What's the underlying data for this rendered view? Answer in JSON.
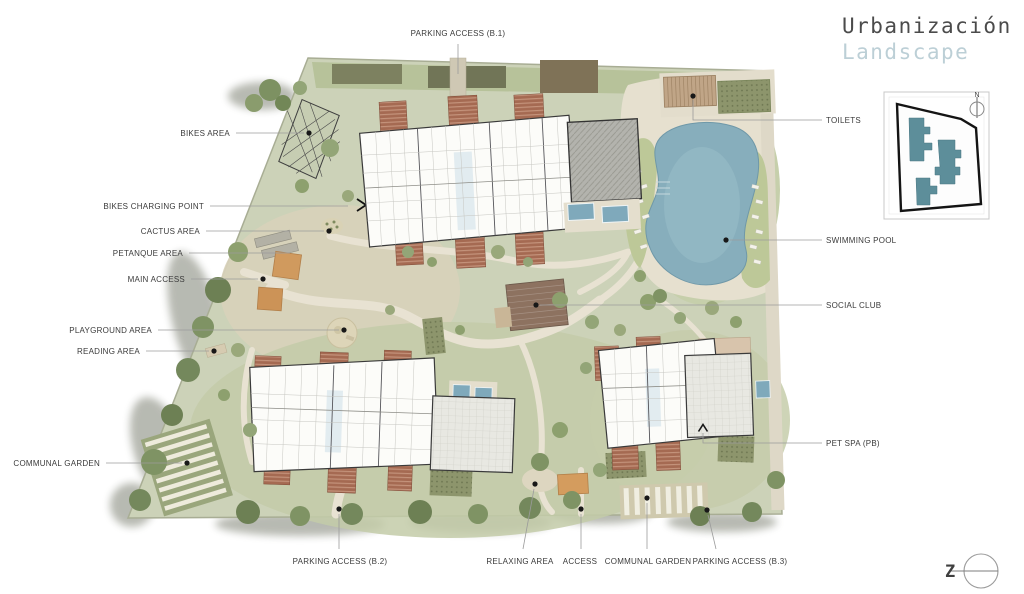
{
  "title": {
    "line1": "Urbanización",
    "line2": "Landscape"
  },
  "key_map": {
    "north_label": "N"
  },
  "logo": {
    "letter": "Z"
  },
  "colors": {
    "site_green": "#ccd2b8",
    "lawn_green": "#b7c29a",
    "path_beige": "#e6e0cf",
    "building_fill": "#fcfcf9",
    "building_outline": "#3a3a3a",
    "roof_terracotta": "#a56a52",
    "roof_gray": "#b3b3ad",
    "pool_blue": "#87aebc",
    "keymap_building": "#5d8e9a",
    "label_text": "#3b3b3b",
    "leader_line": "#9b9b9b",
    "title_primary": "#4b4b4b",
    "title_secondary": "#bccfd6"
  },
  "callouts": [
    {
      "id": "parking-access-b1",
      "label": "PARKING ACCESS (B.1)",
      "tx": 458,
      "ty": 36,
      "anchor": "middle",
      "line": "M458,44 L458,74",
      "marker": null
    },
    {
      "id": "bikes-area",
      "label": "BIKES AREA",
      "tx": 230,
      "ty": 136,
      "anchor": "end",
      "line": "M236,133 L304,133",
      "marker": {
        "type": "dot",
        "x": 309,
        "y": 133
      }
    },
    {
      "id": "bikes-charging-point",
      "label": "BIKES CHARGING POINT",
      "tx": 204,
      "ty": 209,
      "anchor": "end",
      "line": "M210,206 L348,206",
      "marker": null
    },
    {
      "id": "cactus-area",
      "label": "CACTUS AREA",
      "tx": 200,
      "ty": 234,
      "anchor": "end",
      "line": "M206,231 L324,231",
      "marker": {
        "type": "dot",
        "x": 329,
        "y": 231
      }
    },
    {
      "id": "petanque-area",
      "label": "PETANQUE AREA",
      "tx": 183,
      "ty": 256,
      "anchor": "end",
      "line": "M189,253 L290,253",
      "marker": null
    },
    {
      "id": "main-access",
      "label": "MAIN ACCESS",
      "tx": 185,
      "ty": 282,
      "anchor": "end",
      "line": "M191,279 L258,279",
      "marker": {
        "type": "dot",
        "x": 263,
        "y": 279
      }
    },
    {
      "id": "playground-area",
      "label": "PLAYGROUND AREA",
      "tx": 152,
      "ty": 333,
      "anchor": "end",
      "line": "M158,330 L339,330",
      "marker": {
        "type": "dot",
        "x": 344,
        "y": 330
      }
    },
    {
      "id": "reading-area",
      "label": "READING AREA",
      "tx": 140,
      "ty": 354,
      "anchor": "end",
      "line": "M146,351 L209,351",
      "marker": {
        "type": "dot",
        "x": 214,
        "y": 351
      }
    },
    {
      "id": "communal-garden-west",
      "label": "COMMUNAL GARDEN",
      "tx": 100,
      "ty": 466,
      "anchor": "end",
      "line": "M106,463 L182,463",
      "marker": {
        "type": "dot",
        "x": 187,
        "y": 463
      }
    },
    {
      "id": "toilets",
      "label": "TOILETS",
      "tx": 826,
      "ty": 123,
      "anchor": "start",
      "line": "M822,120 L693,120 L693,100",
      "marker": {
        "type": "dot",
        "x": 693,
        "y": 96
      }
    },
    {
      "id": "swimming-pool",
      "label": "SWIMMING POOL",
      "tx": 826,
      "ty": 243,
      "anchor": "start",
      "line": "M822,240 L730,240",
      "marker": {
        "type": "dot",
        "x": 726,
        "y": 240
      }
    },
    {
      "id": "social-club",
      "label": "SOCIAL CLUB",
      "tx": 826,
      "ty": 308,
      "anchor": "start",
      "line": "M822,305 L540,305",
      "marker": {
        "type": "dot",
        "x": 536,
        "y": 305
      }
    },
    {
      "id": "pet-spa",
      "label": "PET SPA (PB)",
      "tx": 826,
      "ty": 446,
      "anchor": "start",
      "line": "M822,443 L703,443 L703,433",
      "marker": {
        "type": "chevron",
        "x": 703,
        "y": 428
      }
    },
    {
      "id": "parking-access-b2",
      "label": "PARKING ACCESS (B.2)",
      "tx": 340,
      "ty": 564,
      "anchor": "middle",
      "line": "M339,514 L339,549",
      "marker": {
        "type": "dot",
        "x": 339,
        "y": 509
      }
    },
    {
      "id": "relaxing-area",
      "label": "RELAXING AREA",
      "tx": 520,
      "ty": 564,
      "anchor": "middle",
      "line": "M534,489 L523,549",
      "marker": {
        "type": "dot",
        "x": 535,
        "y": 484
      }
    },
    {
      "id": "access",
      "label": "ACCESS",
      "tx": 580,
      "ty": 564,
      "anchor": "middle",
      "line": "M581,514 L581,549",
      "marker": {
        "type": "dot",
        "x": 581,
        "y": 509
      }
    },
    {
      "id": "communal-garden-south",
      "label": "COMMUNAL GARDEN",
      "tx": 648,
      "ty": 564,
      "anchor": "middle",
      "line": "M647,503 L647,549",
      "marker": {
        "type": "dot",
        "x": 647,
        "y": 498
      }
    },
    {
      "id": "parking-access-b3",
      "label": "PARKING ACCESS (B.3)",
      "tx": 740,
      "ty": 564,
      "anchor": "middle",
      "line": "M708,515 L716,549",
      "marker": {
        "type": "dot",
        "x": 707,
        "y": 510
      }
    }
  ]
}
